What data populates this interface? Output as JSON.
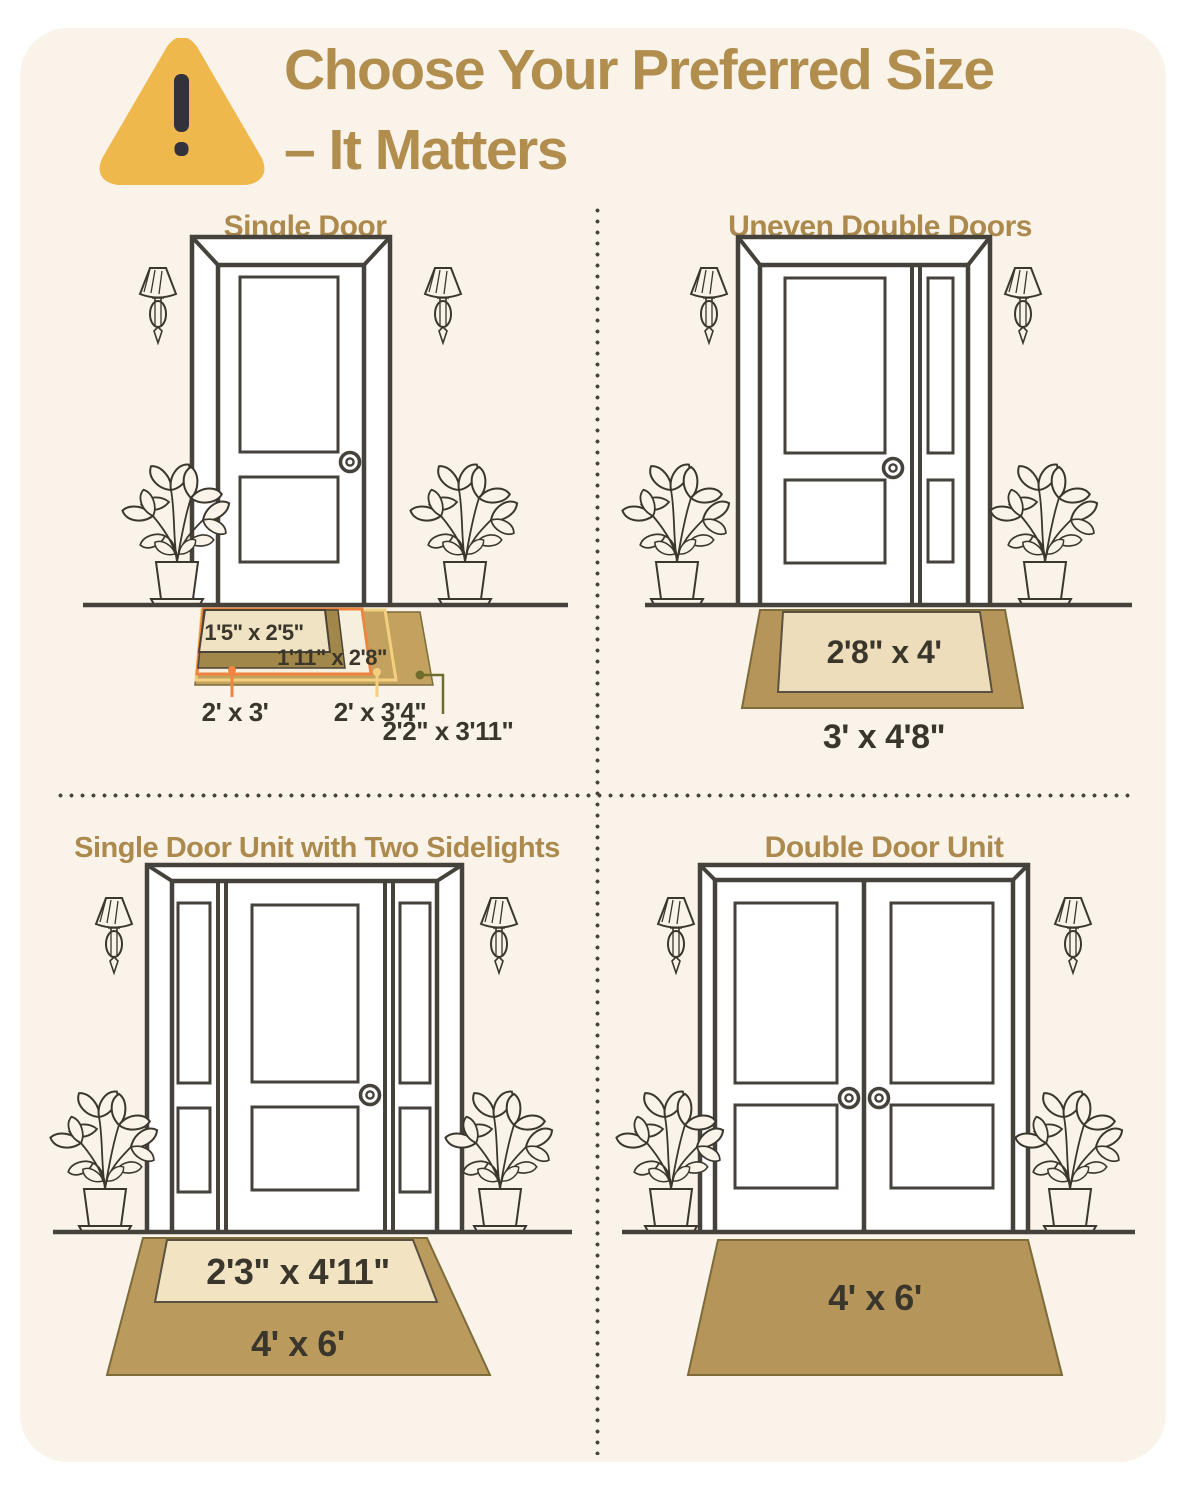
{
  "header": {
    "title_line1": "Choose Your Preferred Size",
    "title_line2": "– It Matters",
    "warning_icon": "warning-triangle-icon"
  },
  "quadrants": {
    "single_door": {
      "title": "Single Door",
      "mat_sizes": {
        "size_1": "1'5\" x 2'5\"",
        "size_2": "1'11\" x 2'8\"",
        "size_3": "2' x 3'",
        "size_4": "2' x 3'4\"",
        "size_5": "2'2\" x 3'11\""
      }
    },
    "uneven_double_doors": {
      "title": "Uneven Double Doors",
      "mat_sizes": {
        "inner": "2'8\" x 4'",
        "outer": "3' x 4'8\""
      }
    },
    "single_door_two_sidelights": {
      "title": "Single Door Unit with Two Sidelights",
      "mat_sizes": {
        "inner": "2'3\" x 4'11\"",
        "outer": "4' x 6'"
      }
    },
    "double_door_unit": {
      "title": "Double Door Unit",
      "mat_sizes": {
        "single": "4' x 6'"
      }
    }
  },
  "colors": {
    "card_background": "#faf3ea",
    "title_gold": "#b18e4e",
    "section_title_gold": "#ac8a4e",
    "outline_dark": "#45423c",
    "label_dark": "#3a362c",
    "mat_tan": "#c2a25e",
    "mat_tan_dark": "#a2874a",
    "mat_cream": "#efe3c4",
    "mat_cream_light": "#f6efdd",
    "accent_orange": "#ef8440",
    "accent_gold": "#f3cf7f",
    "accent_olive": "#6f6d2c",
    "warning_yellow": "#eeb84d"
  }
}
